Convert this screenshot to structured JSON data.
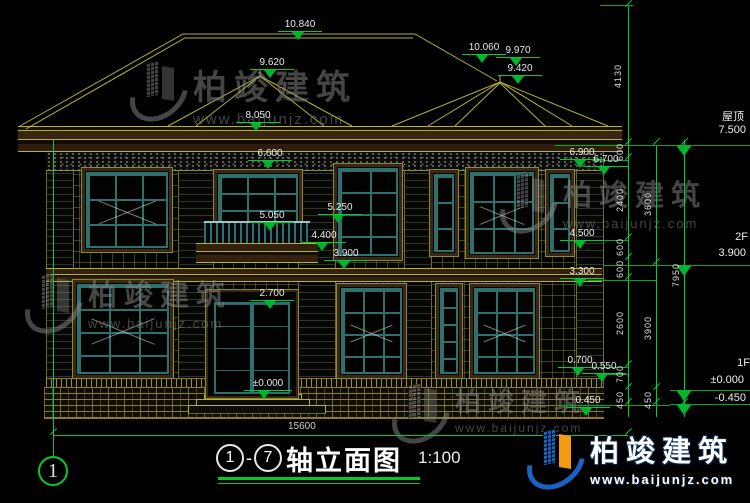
{
  "watermark": {
    "brand": "柏竣建筑",
    "url": "www.baijunjz.com"
  },
  "elevation_markers": [
    "10.840",
    "9.620",
    "8.050",
    "10.060",
    "9.970",
    "9.420",
    "6.600",
    "5.250",
    "5.050",
    "4.400",
    "3.900",
    "2.700",
    "±0.000",
    "6.900",
    "6.700",
    "4.500",
    "3.300",
    "0.700",
    "0.550",
    "0.450"
  ],
  "floor_levels": {
    "roof_label": "屋顶",
    "roof_value": "7.500",
    "f2_label": "2F",
    "f2_value": "3.900",
    "f1_label": "1F",
    "f1_value": "±0.000",
    "base_value": "-0.450"
  },
  "dim_chain_inner": [
    "4130",
    "600",
    "2400",
    "600",
    "600",
    "2600",
    "700",
    "450"
  ],
  "dim_chain_mid": [
    "3600",
    "3900",
    "450"
  ],
  "dim_chain_outer": [
    "7950"
  ],
  "dim_total_width": "15600",
  "titlebar": {
    "axis_bubble": "1",
    "axis_start": "1",
    "axis_end": "7",
    "dash": "-",
    "name": "轴立面图",
    "scale": "1:100"
  }
}
